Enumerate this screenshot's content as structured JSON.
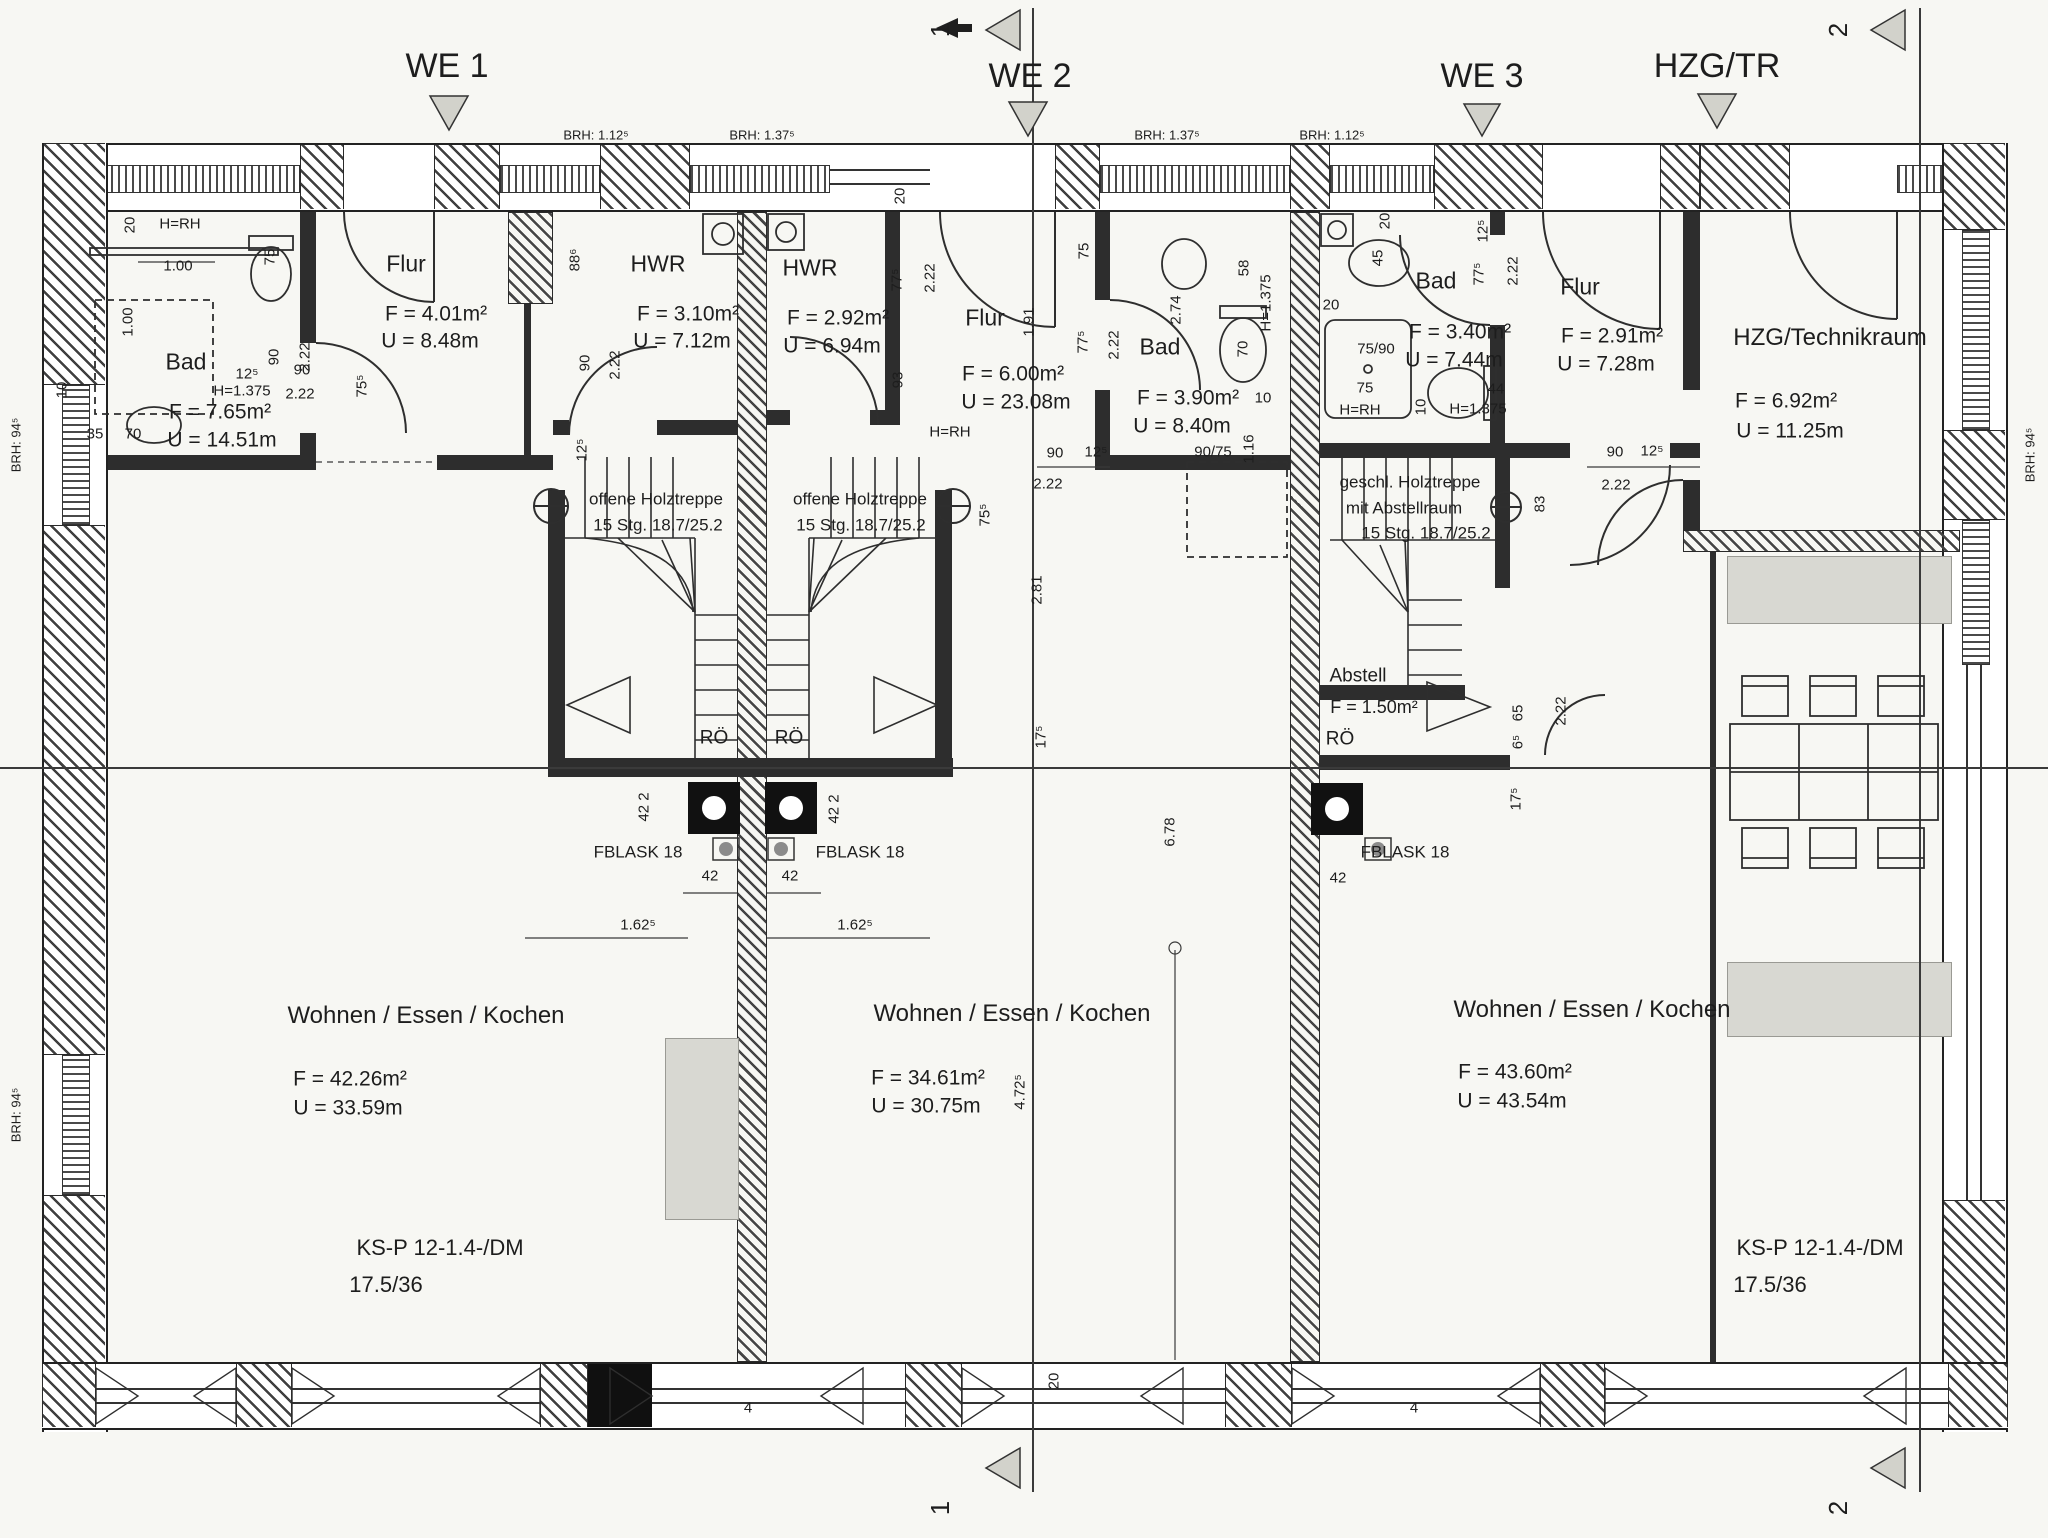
{
  "canvas": {
    "w": 2048,
    "h": 1538,
    "paper": "#f7f7f3",
    "ink": "#1f1f1f",
    "gray_fill": "#d8d8d2",
    "drawing_type": "floor-plan"
  },
  "headers": [
    {
      "t": "WE 1",
      "x": 447,
      "y": 66
    },
    {
      "t": "WE 2",
      "x": 1030,
      "y": 76
    },
    {
      "t": "WE 3",
      "x": 1482,
      "y": 76
    },
    {
      "t": "HZG/TR",
      "x": 1717,
      "y": 66
    }
  ],
  "section_markers": [
    {
      "t": "1",
      "x": 940,
      "y": 30
    },
    {
      "t": "1",
      "x": 940,
      "y": 1508
    },
    {
      "t": "2",
      "x": 1838,
      "y": 30
    },
    {
      "t": "2",
      "x": 1838,
      "y": 1508
    }
  ],
  "brh_labels": [
    {
      "t": "BRH: 1.12⁵",
      "x": 596,
      "y": 135,
      "r": 0
    },
    {
      "t": "BRH: 1.37⁵",
      "x": 762,
      "y": 135,
      "r": 0
    },
    {
      "t": "BRH: 1.37⁵",
      "x": 1167,
      "y": 135,
      "r": 0
    },
    {
      "t": "BRH: 1.12⁵",
      "x": 1332,
      "y": 135,
      "r": 0
    },
    {
      "t": "BRH: 94⁵",
      "x": 16,
      "y": 445,
      "r": 1
    },
    {
      "t": "BRH: 94⁵",
      "x": 16,
      "y": 1115,
      "r": 1
    },
    {
      "t": "BRH: 94⁵",
      "x": 2030,
      "y": 455,
      "r": 1
    }
  ],
  "rooms": [
    {
      "id": "we1-bad",
      "name": "Bad",
      "nx": 186,
      "ny": 362,
      "f": "F = 7.65m²",
      "fx": 220,
      "fy": 412,
      "u": "U = 14.51m",
      "ux": 222,
      "uy": 440
    },
    {
      "id": "we1-flur",
      "name": "Flur",
      "nx": 406,
      "ny": 264,
      "f": "F = 4.01m²",
      "fx": 436,
      "fy": 314,
      "u": "U = 8.48m",
      "ux": 430,
      "uy": 341
    },
    {
      "id": "we1-hwr",
      "name": "HWR",
      "nx": 658,
      "ny": 264,
      "f": "F = 3.10m²",
      "fx": 688,
      "fy": 314,
      "u": "U = 7.12m",
      "ux": 682,
      "uy": 341
    },
    {
      "id": "we2-hwr",
      "name": "HWR",
      "nx": 810,
      "ny": 268,
      "f": "F = 2.92m²",
      "fx": 838,
      "fy": 318,
      "u": "U = 6.94m",
      "ux": 832,
      "uy": 346
    },
    {
      "id": "we2-flur",
      "name": "Flur",
      "nx": 985,
      "ny": 318,
      "f": "F = 6.00m²",
      "fx": 1013,
      "fy": 374,
      "u": "U = 23.08m",
      "ux": 1016,
      "uy": 402
    },
    {
      "id": "we2-bad",
      "name": "Bad",
      "nx": 1160,
      "ny": 347,
      "f": "F = 3.90m²",
      "fx": 1188,
      "fy": 398,
      "u": "U = 8.40m",
      "ux": 1182,
      "uy": 426
    },
    {
      "id": "we3-bad",
      "name": "Bad",
      "nx": 1436,
      "ny": 281,
      "f": "F = 3.40m²",
      "fx": 1460,
      "fy": 332,
      "u": "U = 7.44m",
      "ux": 1454,
      "uy": 360
    },
    {
      "id": "we3-flur",
      "name": "Flur",
      "nx": 1580,
      "ny": 287,
      "f": "F = 2.91m²",
      "fx": 1612,
      "fy": 336,
      "u": "U = 7.28m",
      "ux": 1606,
      "uy": 364
    },
    {
      "id": "hzg-technikraum",
      "name": "HZG/Technikraum",
      "ns": 24,
      "nx": 1830,
      "ny": 338,
      "f": "F = 6.92m²",
      "fx": 1786,
      "fy": 401,
      "u": "U = 11.25m",
      "ux": 1790,
      "uy": 431
    },
    {
      "id": "we1-wohnen",
      "name": "Wohnen / Essen / Kochen",
      "ns": 24,
      "nx": 426,
      "ny": 1016,
      "f": "F = 42.26m²",
      "fx": 350,
      "fy": 1079,
      "u": "U = 33.59m",
      "ux": 348,
      "uy": 1108
    },
    {
      "id": "we2-wohnen",
      "name": "Wohnen / Essen / Kochen",
      "ns": 24,
      "nx": 1012,
      "ny": 1014,
      "f": "F = 34.61m²",
      "fx": 928,
      "fy": 1078,
      "u": "U = 30.75m",
      "ux": 926,
      "uy": 1106
    },
    {
      "id": "we3-wohnen",
      "name": "Wohnen / Essen / Kochen",
      "ns": 24,
      "nx": 1592,
      "ny": 1010,
      "f": "F = 43.60m²",
      "fx": 1515,
      "fy": 1072,
      "u": "U = 43.54m",
      "ux": 1512,
      "uy": 1101
    },
    {
      "id": "we3-abstell",
      "name": "Abstell",
      "ns": 19,
      "nx": 1358,
      "ny": 676,
      "f": "F = 1.50m²",
      "fs": 18,
      "fx": 1374,
      "fy": 707
    }
  ],
  "stair_notes": [
    {
      "t": "offene Holztreppe",
      "x": 656,
      "y": 499
    },
    {
      "t": "15 Stg. 18.7/25.2",
      "x": 658,
      "y": 525
    },
    {
      "t": "offene Holztreppe",
      "x": 860,
      "y": 499
    },
    {
      "t": "15 Stg. 18.7/25.2",
      "x": 861,
      "y": 525
    },
    {
      "t": "geschl. Holztreppe",
      "x": 1410,
      "y": 482
    },
    {
      "t": "mit Abstellraum",
      "x": 1404,
      "y": 508
    },
    {
      "t": "15 Stg. 18.7/25.2",
      "x": 1426,
      "y": 533
    }
  ],
  "annotations": [
    {
      "t": "RÖ",
      "x": 714,
      "y": 738,
      "s": 19
    },
    {
      "t": "RÖ",
      "x": 789,
      "y": 738,
      "s": 19
    },
    {
      "t": "RÖ",
      "x": 1340,
      "y": 739,
      "s": 19
    },
    {
      "t": "FBLASK 18",
      "x": 638,
      "y": 852,
      "s": 17
    },
    {
      "t": "FBLASK 18",
      "x": 860,
      "y": 852,
      "s": 17
    },
    {
      "t": "FBLASK 18",
      "x": 1405,
      "y": 852,
      "s": 17
    },
    {
      "t": "KS-P 12-1.4-/DM",
      "x": 440,
      "y": 1248,
      "s": 22
    },
    {
      "t": "17.5/36",
      "x": 386,
      "y": 1285,
      "s": 22
    },
    {
      "t": "KS-P 12-1.4-/DM",
      "x": 1820,
      "y": 1248,
      "s": 22
    },
    {
      "t": "17.5/36",
      "x": 1770,
      "y": 1285,
      "s": 22
    },
    {
      "t": "H=RH",
      "x": 180,
      "y": 224,
      "s": 15
    },
    {
      "t": "H=RH",
      "x": 950,
      "y": 432,
      "s": 15
    },
    {
      "t": "H=RH",
      "x": 1360,
      "y": 410,
      "s": 15
    },
    {
      "t": "H=1.375",
      "x": 242,
      "y": 391,
      "s": 15
    },
    {
      "t": "H=1.375",
      "x": 1266,
      "y": 303,
      "s": 15,
      "r": 1
    },
    {
      "t": "H=1.375",
      "x": 1478,
      "y": 409,
      "s": 15
    }
  ],
  "dimensions": [
    {
      "t": "20",
      "x": 130,
      "y": 225,
      "r": 1
    },
    {
      "t": "1.00",
      "x": 178,
      "y": 266
    },
    {
      "t": "1.00",
      "x": 128,
      "y": 322,
      "r": 1
    },
    {
      "t": "75",
      "x": 270,
      "y": 257,
      "r": 1
    },
    {
      "t": "90",
      "x": 274,
      "y": 357,
      "r": 1
    },
    {
      "t": "2.22",
      "x": 305,
      "y": 357,
      "r": 1
    },
    {
      "t": "10",
      "x": 62,
      "y": 390,
      "r": 1
    },
    {
      "t": "35",
      "x": 95,
      "y": 434
    },
    {
      "t": "70",
      "x": 133,
      "y": 434
    },
    {
      "t": "12⁵",
      "x": 247,
      "y": 374
    },
    {
      "t": "90",
      "x": 302,
      "y": 370
    },
    {
      "t": "2.22",
      "x": 300,
      "y": 394
    },
    {
      "t": "75⁵",
      "x": 362,
      "y": 386,
      "r": 1
    },
    {
      "t": "88⁶",
      "x": 575,
      "y": 260,
      "r": 1
    },
    {
      "t": "90",
      "x": 585,
      "y": 363,
      "r": 1
    },
    {
      "t": "2.22",
      "x": 615,
      "y": 365,
      "r": 1
    },
    {
      "t": "12⁵",
      "x": 582,
      "y": 450,
      "r": 1
    },
    {
      "t": "75⁵",
      "x": 985,
      "y": 515,
      "r": 1
    },
    {
      "t": "20",
      "x": 900,
      "y": 196,
      "r": 1
    },
    {
      "t": "77⁵",
      "x": 897,
      "y": 280,
      "r": 1
    },
    {
      "t": "2.22",
      "x": 930,
      "y": 278,
      "r": 1
    },
    {
      "t": "93",
      "x": 898,
      "y": 380,
      "r": 1
    },
    {
      "t": "1.91",
      "x": 1029,
      "y": 322,
      "r": 1
    },
    {
      "t": "75",
      "x": 1084,
      "y": 251,
      "r": 1
    },
    {
      "t": "77⁵",
      "x": 1083,
      "y": 342,
      "r": 1
    },
    {
      "t": "2.22",
      "x": 1114,
      "y": 345,
      "r": 1
    },
    {
      "t": "90",
      "x": 1055,
      "y": 453
    },
    {
      "t": "12⁵",
      "x": 1096,
      "y": 452
    },
    {
      "t": "2.22",
      "x": 1048,
      "y": 484
    },
    {
      "t": "2.74",
      "x": 1176,
      "y": 310,
      "r": 1
    },
    {
      "t": "58",
      "x": 1244,
      "y": 268,
      "r": 1
    },
    {
      "t": "70",
      "x": 1243,
      "y": 349,
      "r": 1
    },
    {
      "t": "10",
      "x": 1263,
      "y": 398
    },
    {
      "t": "90/75",
      "x": 1213,
      "y": 452
    },
    {
      "t": "1.16",
      "x": 1249,
      "y": 449,
      "r": 1
    },
    {
      "t": "2.81",
      "x": 1037,
      "y": 590,
      "r": 1
    },
    {
      "t": "17⁵",
      "x": 1041,
      "y": 737,
      "r": 1
    },
    {
      "t": "6.78",
      "x": 1170,
      "y": 832,
      "r": 1
    },
    {
      "t": "4.72⁵",
      "x": 1020,
      "y": 1092,
      "r": 1
    },
    {
      "t": "20",
      "x": 1385,
      "y": 221,
      "r": 1
    },
    {
      "t": "45",
      "x": 1378,
      "y": 258,
      "r": 1
    },
    {
      "t": "20",
      "x": 1331,
      "y": 305
    },
    {
      "t": "75/90",
      "x": 1376,
      "y": 349
    },
    {
      "t": "75",
      "x": 1365,
      "y": 388
    },
    {
      "t": "12⁵",
      "x": 1483,
      "y": 231,
      "r": 1
    },
    {
      "t": "77⁵",
      "x": 1479,
      "y": 274,
      "r": 1
    },
    {
      "t": "2.22",
      "x": 1513,
      "y": 271,
      "r": 1
    },
    {
      "t": "44",
      "x": 1496,
      "y": 389
    },
    {
      "t": "10",
      "x": 1421,
      "y": 407,
      "r": 1
    },
    {
      "t": "90",
      "x": 1615,
      "y": 452
    },
    {
      "t": "12⁵",
      "x": 1652,
      "y": 451
    },
    {
      "t": "2.22",
      "x": 1616,
      "y": 485
    },
    {
      "t": "83",
      "x": 1540,
      "y": 504,
      "r": 1
    },
    {
      "t": "65",
      "x": 1518,
      "y": 713,
      "r": 1
    },
    {
      "t": "6⁵",
      "x": 1518,
      "y": 742,
      "r": 1
    },
    {
      "t": "2.22",
      "x": 1561,
      "y": 711,
      "r": 1
    },
    {
      "t": "17⁵",
      "x": 1516,
      "y": 799,
      "r": 1
    },
    {
      "t": "42 2",
      "x": 644,
      "y": 807,
      "r": 1
    },
    {
      "t": "42 2",
      "x": 834,
      "y": 809,
      "r": 1
    },
    {
      "t": "42",
      "x": 710,
      "y": 876
    },
    {
      "t": "42",
      "x": 790,
      "y": 876
    },
    {
      "t": "42",
      "x": 1338,
      "y": 878
    },
    {
      "t": "1.62⁵",
      "x": 638,
      "y": 925
    },
    {
      "t": "1.62⁵",
      "x": 855,
      "y": 925
    },
    {
      "t": "4",
      "x": 748,
      "y": 1408
    },
    {
      "t": "4",
      "x": 1414,
      "y": 1408
    },
    {
      "t": "20",
      "x": 1054,
      "y": 1381,
      "r": 1
    }
  ]
}
